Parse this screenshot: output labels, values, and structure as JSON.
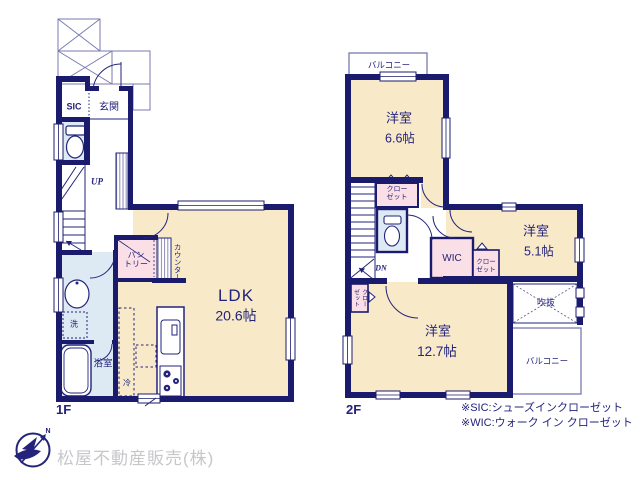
{
  "palette": {
    "wall_navy": "#1b1b6d",
    "text_navy": "#23237c",
    "room_tan": "#f8e9c9",
    "closet_pink": "#fbdfe6",
    "wet_blue": "#dde9f3",
    "thin_line": "#7a7ab0",
    "company_gray": "#c7c7cb"
  },
  "floor1": {
    "floor_label": "1F",
    "rooms": {
      "sic": "SIC",
      "genkan": "玄関",
      "up": "UP",
      "counter": "カウンター",
      "pantry": "パン\nトリー",
      "ldk_name": "LDK",
      "ldk_size": "20.6帖",
      "laundry": "洗",
      "bath": "浴室",
      "fridge": "冷"
    }
  },
  "floor2": {
    "floor_label": "2F",
    "rooms": {
      "balcony_top": "バルコニー",
      "room1_name": "洋室",
      "room1_size": "6.6帖",
      "closet1": "クロー\nゼット",
      "dn": "DN",
      "wic": "WIC",
      "closet2": "クロー\nゼット",
      "room2_name": "洋室",
      "room2_size": "5.1帖",
      "void": "吹抜",
      "balcony_right": "バルコニー",
      "room3_name": "洋室",
      "room3_size": "12.7帖",
      "closet3": "クロー\nゼット"
    }
  },
  "footer": {
    "company": "松屋不動産販売(株)",
    "logo_n": "N",
    "note_sic": "※SIC:シューズインクローゼット",
    "note_wic": "※WIC:ウォーク イン クローゼット"
  }
}
